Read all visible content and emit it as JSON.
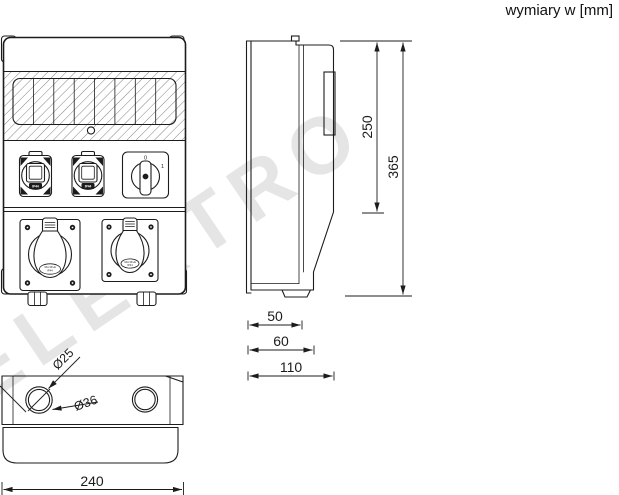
{
  "title": "wymiary w [mm]",
  "watermark": "ELEKTRO",
  "colors": {
    "line": "#1c1c1c",
    "watermark": "#cccccc",
    "background": "#ffffff"
  },
  "dimensions": {
    "inner_height": "250",
    "total_height": "365",
    "depth_base": "50",
    "depth_mid": "60",
    "depth_total": "110",
    "total_width": "240",
    "knockout_small": "Ø25",
    "knockout_large": "Ø36"
  },
  "front_view": {
    "switch": {
      "off": "0",
      "on": "1"
    },
    "small_socket_label": "IP44",
    "cee_left_label_line1": "16A 3P+E",
    "cee_left_label_line2": "IP44",
    "cee_right_label_line1": "16A 3P+E",
    "cee_right_label_line2": "IP44"
  }
}
